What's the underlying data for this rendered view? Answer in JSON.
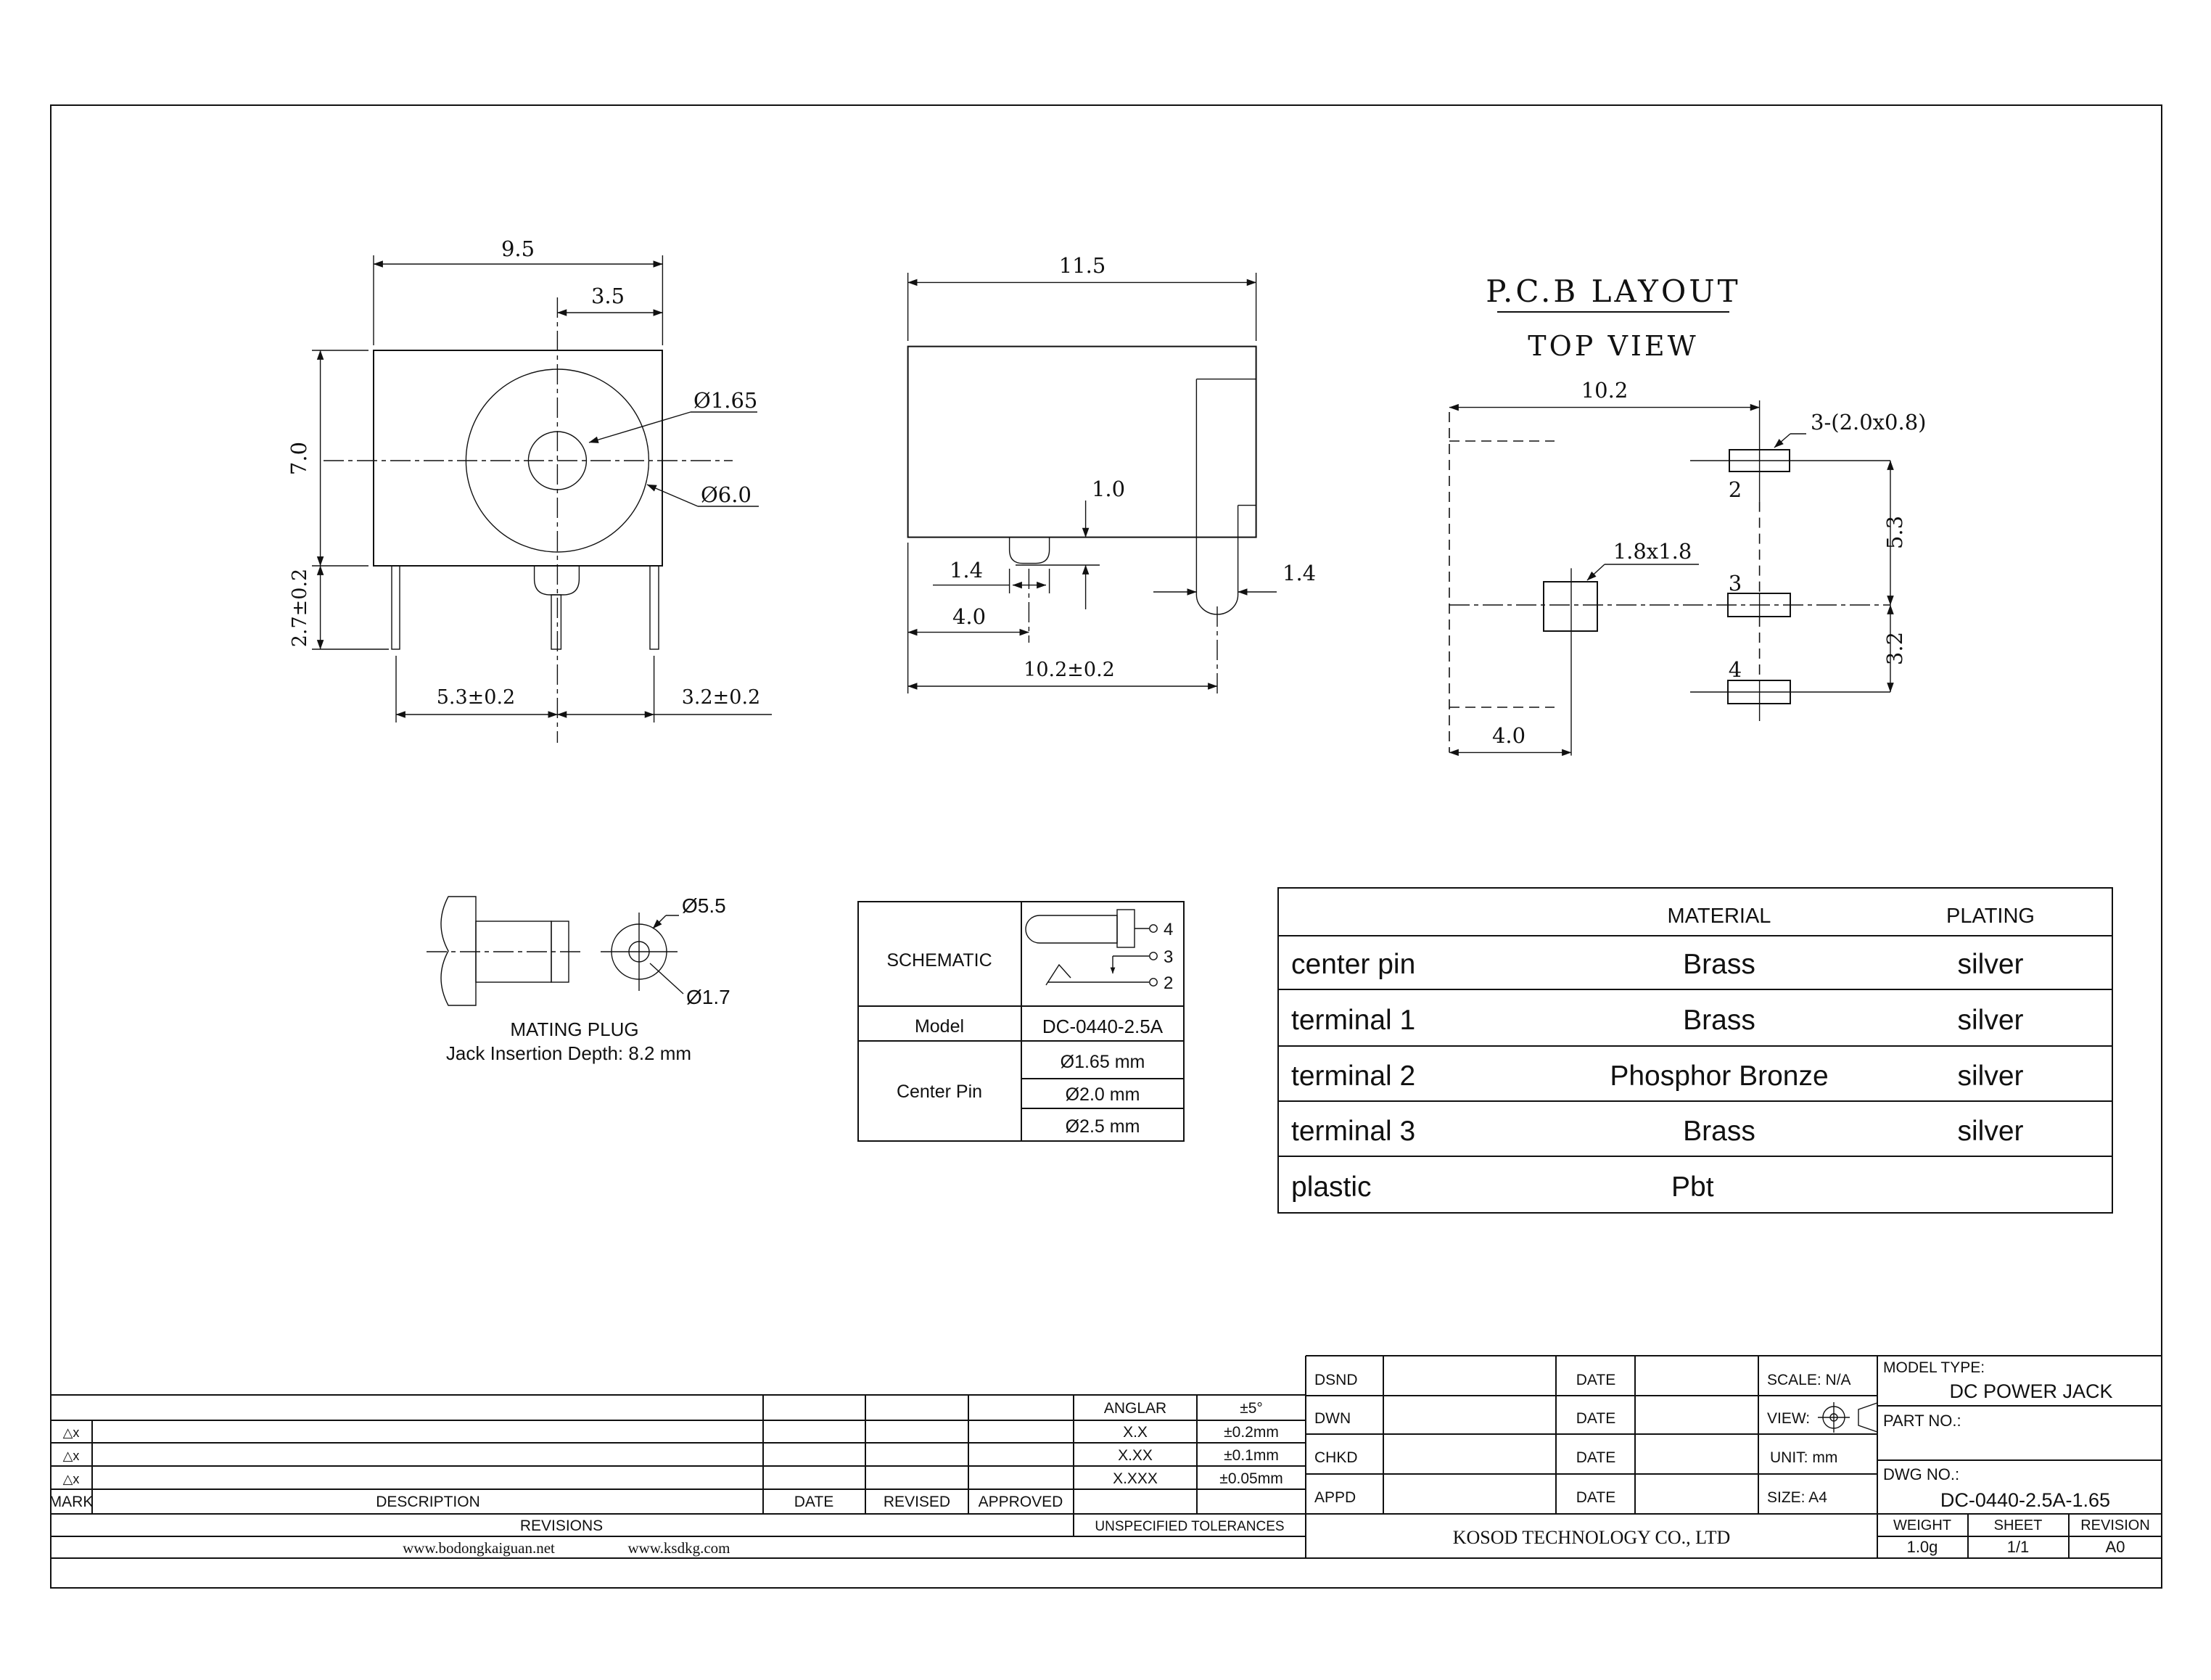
{
  "front_view": {
    "width": "9.5",
    "center_offset": "3.5",
    "pin_diameter": "Ø1.65",
    "barrel_diameter": "Ø6.0",
    "height": "7.0",
    "leg_length": "2.7±0.2",
    "pitch_left": "5.3±0.2",
    "pitch_right": "3.2±0.2"
  },
  "side_view": {
    "depth": "11.5",
    "boss_height": "1.0",
    "pin_width": "1.4",
    "pin_offset": "4.0",
    "terminal_offset": "10.2±0.2",
    "terminal_width": "1.4"
  },
  "pcb_layout": {
    "title": "P.C.B LAYOUT",
    "subtitle": "TOP VIEW",
    "span": "10.2",
    "slot_note": "3-(2.0x0.8)",
    "pad_note": "1.8x1.8",
    "pitch_upper": "5.3",
    "pitch_lower": "3.2",
    "pad_offset": "4.0",
    "pad2": "2",
    "pad3": "3",
    "pad4": "4"
  },
  "mating_plug": {
    "outer_diameter": "Ø5.5",
    "inner_diameter": "Ø1.7",
    "title": "MATING PLUG",
    "note": "Jack Insertion Depth: 8.2 mm"
  },
  "spec_table": {
    "schematic_label": "SCHEMATIC",
    "pin4": "4",
    "pin3": "3",
    "pin2": "2",
    "model_label": "Model",
    "model_value": "DC-0440-2.5A",
    "center_pin_label": "Center Pin",
    "center_pin_opt1": "Ø1.65 mm",
    "center_pin_opt2": "Ø2.0 mm",
    "center_pin_opt3": "Ø2.5 mm"
  },
  "material_table": {
    "col_material": "MATERIAL",
    "col_plating": "PLATING",
    "rows": [
      {
        "part": "center pin",
        "material": "Brass",
        "plating": "silver"
      },
      {
        "part": "terminal 1",
        "material": "Brass",
        "plating": "silver"
      },
      {
        "part": "terminal 2",
        "material": "Phosphor Bronze",
        "plating": "silver"
      },
      {
        "part": "terminal 3",
        "material": "Brass",
        "plating": "silver"
      },
      {
        "part": "plastic",
        "material": "Pbt",
        "plating": ""
      }
    ]
  },
  "title_block": {
    "mark_label": "MARK",
    "description_label": "DESCRIPTION",
    "date_label": "DATE",
    "revised_label": "REVISED",
    "approved_label": "APPROVED",
    "revisions_label": "REVISIONS",
    "delta1": "△x",
    "delta2": "△x",
    "delta3": "△x",
    "tol_title": "UNSPECIFIED TOLERANCES",
    "tol_rows": [
      {
        "name": "ANGLAR",
        "value": "±5°"
      },
      {
        "name": "X.X",
        "value": "±0.2mm"
      },
      {
        "name": "X.XX",
        "value": "±0.1mm"
      },
      {
        "name": "X.XXX",
        "value": "±0.05mm"
      }
    ],
    "site1": "www.bodongkaiguan.net",
    "site2": "www.ksdkg.com",
    "dsnd": "DSND",
    "dwn": "DWN",
    "chkd": "CHKD",
    "appd": "APPD",
    "date1": "DATE",
    "date2": "DATE",
    "date3": "DATE",
    "date4": "DATE",
    "scale": "SCALE: N/A",
    "view": "VIEW:",
    "unit": "UNIT: mm",
    "size": "SIZE: A4",
    "company": "KOSOD TECHNOLOGY CO., LTD",
    "model_type_label": "MODEL TYPE:",
    "model_type": "DC POWER JACK",
    "part_no_label": "PART NO.:",
    "dwg_no_label": "DWG NO.:",
    "dwg_no": "DC-0440-2.5A-1.65",
    "weight_label": "WEIGHT",
    "sheet_label": "SHEET",
    "revision_label": "REVISION",
    "weight": "1.0g",
    "sheet": "1/1",
    "revision": "A0"
  }
}
